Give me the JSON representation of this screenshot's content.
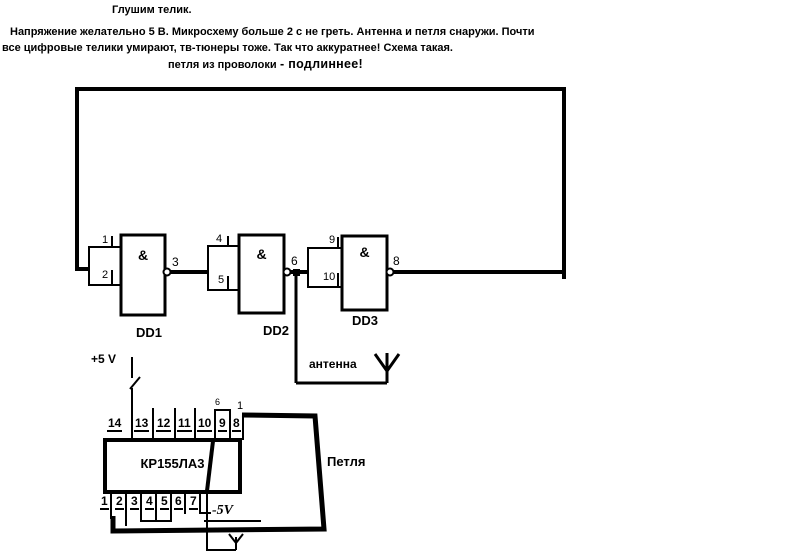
{
  "colors": {
    "ink": "#000000",
    "bg": "#ffffff"
  },
  "header": {
    "title": "Глушим телик.",
    "line1": "Напряжение желательно 5 В. Микросхему больше 2 с не греть. Антенна и петля снаружи. Почти",
    "line2": "все цифровые телики умирают, тв-тюнеры тоже. Так что аккуратнее! Схема такая.",
    "loop_note": "петля из проволоки",
    "loop_note_emphasis": "- подлиннее!"
  },
  "gates": {
    "dd1": {
      "label": "DD1",
      "symbol": "&",
      "in_top": "1",
      "in_bottom": "2",
      "out": "3"
    },
    "dd2": {
      "label": "DD2",
      "symbol": "&",
      "in_top": "4",
      "in_bottom": "5",
      "out": "6"
    },
    "dd3": {
      "label": "DD3",
      "symbol": "&",
      "in_top": "9",
      "in_bottom": "10",
      "out": "8"
    }
  },
  "antenna": {
    "label": "антенна"
  },
  "ic": {
    "name": "КР155ЛА3",
    "top_pins": [
      "14",
      "13",
      "12",
      "11",
      "10",
      "9",
      "8"
    ],
    "bottom_pins": [
      "1",
      "2",
      "3",
      "4",
      "5",
      "6",
      "7"
    ],
    "jumper_label": "6",
    "loop_pin_label": "1",
    "supply_pos": "+5 V",
    "supply_neg": "-5V",
    "loop_label": "Петля"
  },
  "icons": {
    "antenna": "v-shaped antenna on stem",
    "switch": "open switch blade in +5V feed",
    "ground_antenna": "small Y antenna at bottom"
  }
}
